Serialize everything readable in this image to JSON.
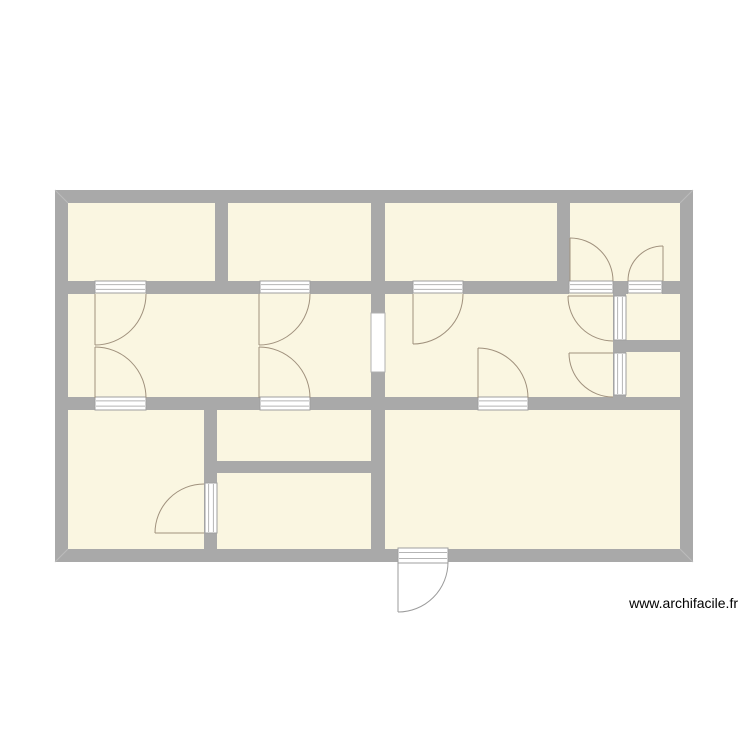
{
  "watermark": {
    "text": "www.archifacile.fr"
  },
  "colors": {
    "background": "#ffffff",
    "floor_fill": "#faf6e1",
    "wall_fill": "#a9a9a9",
    "miter_line": "#bcbcbc",
    "threshold_fill": "#ffffff",
    "threshold_border": "#9f9f9f",
    "threshold_line": "#b5b5b5",
    "opening_fill": "#ffffff",
    "opening_border": "#b0b0b0",
    "door_arc": "#a0917d",
    "entrance_arc": "#9b9b9b"
  },
  "plan": {
    "bounds": {
      "x": 55,
      "y": 190,
      "w": 638,
      "h": 372,
      "wall_thickness": 13
    },
    "floor_base": {
      "x": 55,
      "y": 190,
      "w": 638,
      "h": 372
    },
    "walls": [
      {
        "id": "outer-top",
        "x": 55,
        "y": 190,
        "w": 638,
        "h": 13
      },
      {
        "id": "outer-bottom",
        "x": 55,
        "y": 549,
        "w": 638,
        "h": 13
      },
      {
        "id": "outer-left",
        "x": 55,
        "y": 190,
        "w": 13,
        "h": 372
      },
      {
        "id": "outer-right",
        "x": 680,
        "y": 190,
        "w": 13,
        "h": 372
      },
      {
        "id": "mid-wall-seg-1",
        "x": 68,
        "y": 281,
        "w": 27,
        "h": 13
      },
      {
        "id": "mid-wall-seg-2",
        "x": 146,
        "y": 281,
        "w": 114,
        "h": 13
      },
      {
        "id": "mid-wall-seg-3",
        "x": 310,
        "y": 281,
        "w": 103,
        "h": 13
      },
      {
        "id": "mid-wall-seg-4",
        "x": 463,
        "y": 281,
        "w": 106,
        "h": 13
      },
      {
        "id": "mid-wall-post",
        "x": 613,
        "y": 281,
        "w": 15,
        "h": 13
      },
      {
        "id": "mid-wall-seg-5",
        "x": 662,
        "y": 281,
        "w": 18,
        "h": 13
      },
      {
        "id": "hall-south-seg-1",
        "x": 68,
        "y": 397,
        "w": 27,
        "h": 13
      },
      {
        "id": "hall-south-seg-2",
        "x": 146,
        "y": 397,
        "w": 114,
        "h": 13
      },
      {
        "id": "hall-south-seg-3",
        "x": 310,
        "y": 397,
        "w": 168,
        "h": 13
      },
      {
        "id": "hall-south-seg-4",
        "x": 528,
        "y": 397,
        "w": 152,
        "h": 13
      },
      {
        "id": "top-divider-1",
        "x": 215,
        "y": 200,
        "w": 13,
        "h": 94
      },
      {
        "id": "top-divider-2-upper",
        "x": 371,
        "y": 200,
        "w": 14,
        "h": 113
      },
      {
        "id": "top-divider-2-lower",
        "x": 371,
        "y": 372,
        "w": 14,
        "h": 180
      },
      {
        "id": "top-divider-3",
        "x": 557,
        "y": 200,
        "w": 13,
        "h": 81
      },
      {
        "id": "right-column-wall",
        "x": 613,
        "y": 294,
        "w": 13,
        "h": 103
      },
      {
        "id": "right-column-divider",
        "x": 626,
        "y": 340,
        "w": 54,
        "h": 12
      },
      {
        "id": "bottom-left-divider",
        "x": 204,
        "y": 404,
        "w": 13,
        "h": 147
      },
      {
        "id": "bottom-center-divider",
        "x": 217,
        "y": 461,
        "w": 154,
        "h": 12
      }
    ],
    "corner_miters": [
      {
        "x1": 55,
        "y1": 190,
        "x2": 68,
        "y2": 203
      },
      {
        "x1": 693,
        "y1": 190,
        "x2": 680,
        "y2": 203
      },
      {
        "x1": 55,
        "y1": 562,
        "x2": 68,
        "y2": 549
      },
      {
        "x1": 693,
        "y1": 562,
        "x2": 680,
        "y2": 549
      }
    ],
    "thresholds": [
      {
        "id": "door-sill-room1-hall",
        "x": 95,
        "y": 281,
        "w": 51,
        "h": 12,
        "o": "h"
      },
      {
        "id": "door-sill-room2-hall",
        "x": 260,
        "y": 281,
        "w": 50,
        "h": 12,
        "o": "h"
      },
      {
        "id": "door-sill-room3-hall",
        "x": 413,
        "y": 281,
        "w": 50,
        "h": 12,
        "o": "h"
      },
      {
        "id": "door-sill-room4-left",
        "x": 569,
        "y": 281,
        "w": 44,
        "h": 12,
        "o": "h"
      },
      {
        "id": "door-sill-room4-right",
        "x": 628,
        "y": 281,
        "w": 34,
        "h": 12,
        "o": "h"
      },
      {
        "id": "door-sill-hall-bl",
        "x": 95,
        "y": 397,
        "w": 51,
        "h": 13,
        "o": "h"
      },
      {
        "id": "door-sill-hall-bc",
        "x": 260,
        "y": 397,
        "w": 50,
        "h": 13,
        "o": "h"
      },
      {
        "id": "door-sill-hall-living",
        "x": 478,
        "y": 397,
        "w": 50,
        "h": 13,
        "o": "h"
      },
      {
        "id": "door-sill-small-upper",
        "x": 614,
        "y": 296,
        "w": 12,
        "h": 44,
        "o": "v"
      },
      {
        "id": "door-sill-small-lower",
        "x": 614,
        "y": 353,
        "w": 12,
        "h": 42,
        "o": "v"
      },
      {
        "id": "door-sill-bottom-left",
        "x": 205,
        "y": 483,
        "w": 12,
        "h": 50,
        "o": "v"
      },
      {
        "id": "door-sill-entrance",
        "x": 398,
        "y": 548,
        "w": 50,
        "h": 15,
        "o": "h"
      }
    ],
    "openings": [
      {
        "id": "hall-passage",
        "x": 371,
        "y": 313,
        "w": 14,
        "h": 59
      }
    ],
    "doors": [
      {
        "id": "door-hall-room1",
        "hinge": [
          95,
          294
        ],
        "start": [
          146,
          294
        ],
        "end": [
          95,
          345
        ],
        "r": 51,
        "sweep": 1
      },
      {
        "id": "door-hall-bottomleft",
        "hinge": [
          95,
          398
        ],
        "start": [
          146,
          398
        ],
        "end": [
          95,
          347
        ],
        "r": 51,
        "sweep": 0
      },
      {
        "id": "door-hall-room2",
        "hinge": [
          259,
          294
        ],
        "start": [
          310,
          294
        ],
        "end": [
          259,
          345
        ],
        "r": 51,
        "sweep": 1
      },
      {
        "id": "door-hall-bottomcenter",
        "hinge": [
          259,
          398
        ],
        "start": [
          310,
          398
        ],
        "end": [
          259,
          347
        ],
        "r": 51,
        "sweep": 0
      },
      {
        "id": "door-hall-room3",
        "hinge": [
          413,
          294
        ],
        "start": [
          463,
          294
        ],
        "end": [
          413,
          344
        ],
        "r": 50,
        "sweep": 1
      },
      {
        "id": "door-hall-living",
        "hinge": [
          478,
          398
        ],
        "start": [
          528,
          398
        ],
        "end": [
          478,
          348
        ],
        "r": 50,
        "sweep": 0
      },
      {
        "id": "door-small-upper",
        "hinge": [
          613,
          296
        ],
        "start": [
          613,
          341
        ],
        "end": [
          568,
          296
        ],
        "r": 45,
        "sweep": 1
      },
      {
        "id": "door-small-lower",
        "hinge": [
          613,
          353
        ],
        "start": [
          613,
          397
        ],
        "end": [
          569,
          353
        ],
        "r": 44,
        "sweep": 1
      },
      {
        "id": "door-room4-left",
        "hinge": [
          570,
          281
        ],
        "start": [
          613,
          281
        ],
        "end": [
          570,
          238
        ],
        "r": 43,
        "sweep": 0
      },
      {
        "id": "door-room4-right",
        "hinge": [
          663,
          281
        ],
        "start": [
          628,
          281
        ],
        "end": [
          663,
          246
        ],
        "r": 35,
        "sweep": 1
      },
      {
        "id": "door-bottomleft-bc",
        "hinge": [
          204,
          533
        ],
        "start": [
          204,
          484
        ],
        "end": [
          155,
          533
        ],
        "r": 49,
        "sweep": 0
      },
      {
        "id": "door-entrance",
        "hinge": [
          398,
          562
        ],
        "start": [
          448,
          562
        ],
        "end": [
          398,
          612
        ],
        "r": 50,
        "sweep": 1,
        "entrance": true
      }
    ],
    "rooms": [
      {
        "id": "room-top-1",
        "x": 68,
        "y": 203,
        "w": 147,
        "h": 78
      },
      {
        "id": "room-top-2",
        "x": 228,
        "y": 203,
        "w": 143,
        "h": 78
      },
      {
        "id": "room-top-3",
        "x": 385,
        "y": 203,
        "w": 172,
        "h": 78
      },
      {
        "id": "room-top-4",
        "x": 570,
        "y": 203,
        "w": 110,
        "h": 78
      },
      {
        "id": "hall-west",
        "x": 68,
        "y": 294,
        "w": 303,
        "h": 103
      },
      {
        "id": "hall-east",
        "x": 385,
        "y": 294,
        "w": 228,
        "h": 103
      },
      {
        "id": "room-small-upper",
        "x": 626,
        "y": 294,
        "w": 54,
        "h": 46
      },
      {
        "id": "room-small-lower",
        "x": 626,
        "y": 352,
        "w": 54,
        "h": 45
      },
      {
        "id": "room-bottom-left",
        "x": 68,
        "y": 410,
        "w": 136,
        "h": 139
      },
      {
        "id": "room-bc-upper",
        "x": 217,
        "y": 410,
        "w": 154,
        "h": 51
      },
      {
        "id": "room-bc-lower",
        "x": 217,
        "y": 473,
        "w": 154,
        "h": 76
      },
      {
        "id": "room-living",
        "x": 385,
        "y": 410,
        "w": 295,
        "h": 139
      }
    ]
  }
}
